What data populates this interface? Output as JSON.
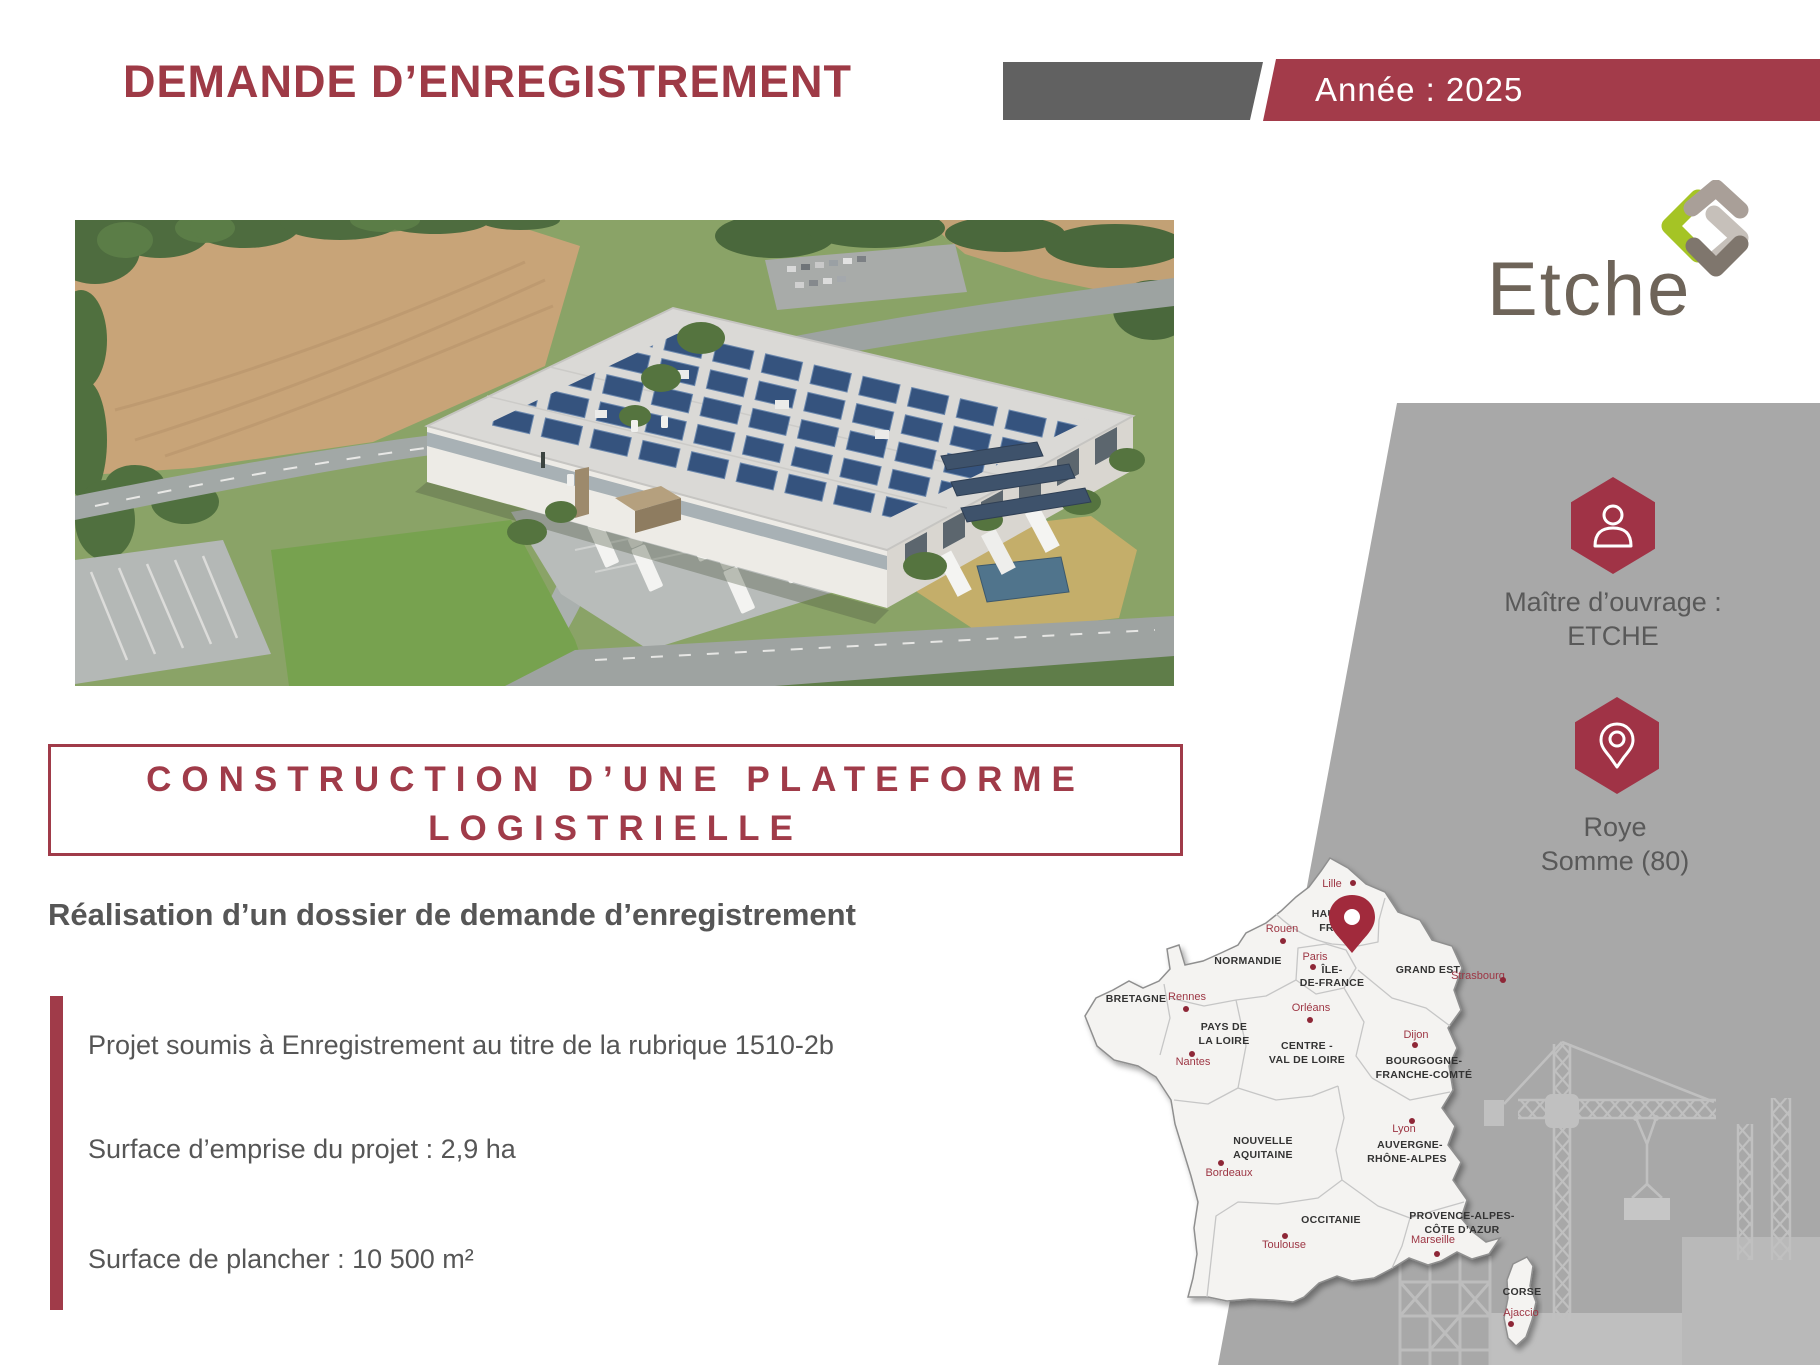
{
  "header": {
    "title": "DEMANDE D’ENREGISTREMENT",
    "year_label": "Année : 2025"
  },
  "logo": {
    "wordmark": "Etche"
  },
  "sidebar": {
    "owner_line1": "Maître d’ouvrage :",
    "owner_line2": "ETCHE",
    "location_line1": "Roye",
    "location_line2": "Somme (80)"
  },
  "project_box": {
    "line1": "CONSTRUCTION D’UNE PLATEFORME",
    "line2": "LOGISTRIELLE"
  },
  "subtitle": "Réalisation d’un dossier de demande d’enregistrement",
  "bullets": [
    {
      "text": "Projet soumis à Enregistrement au titre de la rubrique 1510-2b"
    },
    {
      "text": "Surface d’emprise du projet : 2,9 ha"
    },
    {
      "text": "Surface de plancher : 10 500 m²"
    }
  ],
  "map": {
    "region_labels": [
      {
        "text": "HAUTS-DE-"
      },
      {
        "text": "FRANCE"
      },
      {
        "text": "NORMANDIE"
      },
      {
        "text": "ÎLE-"
      },
      {
        "text": "DE-FRANCE"
      },
      {
        "text": "GRAND EST"
      },
      {
        "text": "BRETAGNE"
      },
      {
        "text": "PAYS DE"
      },
      {
        "text": "LA LOIRE"
      },
      {
        "text": "CENTRE -"
      },
      {
        "text": "VAL DE LOIRE"
      },
      {
        "text": "BOURGOGNE-"
      },
      {
        "text": "FRANCHE-COMTÉ"
      },
      {
        "text": "NOUVELLE"
      },
      {
        "text": "AQUITAINE"
      },
      {
        "text": "AUVERGNE-"
      },
      {
        "text": "RHÔNE-ALPES"
      },
      {
        "text": "OCCITANIE"
      },
      {
        "text": "PROVENCE-ALPES-"
      },
      {
        "text": "CÔTE D’AZUR"
      },
      {
        "text": "CORSE"
      }
    ],
    "cities": [
      {
        "name": "Lille"
      },
      {
        "name": "Rouen"
      },
      {
        "name": "Paris"
      },
      {
        "name": "Strasbourg"
      },
      {
        "name": "Rennes"
      },
      {
        "name": "Nantes"
      },
      {
        "name": "Orléans"
      },
      {
        "name": "Dijon"
      },
      {
        "name": "Bordeaux"
      },
      {
        "name": "Lyon"
      },
      {
        "name": "Toulouse"
      },
      {
        "name": "Marseille"
      },
      {
        "name": "Ajaccio"
      }
    ]
  },
  "colors": {
    "brand_red": "#a03b49",
    "title_red": "#9e3a46",
    "band_gray": "#616161",
    "panel_gray": "#a8a8a8",
    "text_gray": "#565656",
    "silhouette_gray": "#c0c0c0",
    "logo_green": "#a5c425",
    "logo_taupe": "#6e6459"
  }
}
